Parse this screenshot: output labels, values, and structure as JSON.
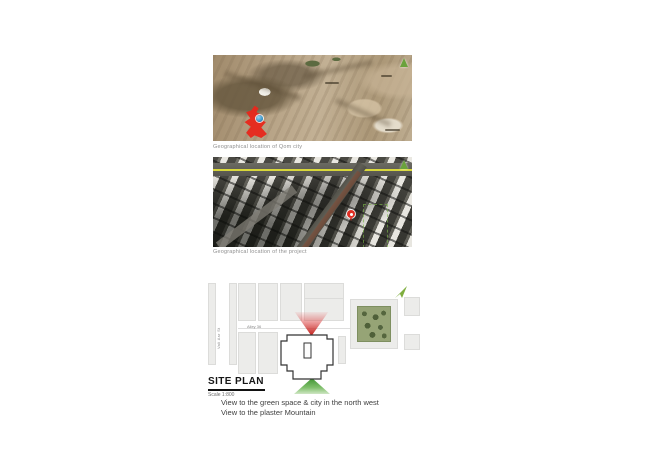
{
  "figures": {
    "map_qom": {
      "caption": "Geographical location of Qom city"
    },
    "map_project": {
      "caption": "Geographical location of the project"
    }
  },
  "site_plan": {
    "title": "SITE PLAN",
    "scale_label": "Scale 1:800",
    "streets": {
      "vertical": "Vali Asr St",
      "horizontal": "Alley 36"
    },
    "notes": [
      "View to the green space & city in the north west",
      "View to the plaster Mountain"
    ]
  },
  "icons": {
    "north_arrow": "north-arrow",
    "location_pin": "location-pin",
    "city_marker": "city-marker"
  },
  "colors": {
    "north_green": "#6aa23c",
    "qom_city_red": "#e8271b",
    "marker_blue": "#2e8fc5",
    "pin_red": "#df2f24",
    "road_yellow": "#d8d73a",
    "view_cone_red": "#c11d17",
    "view_cone_green": "#3e9330",
    "park_green": "#96a476"
  }
}
